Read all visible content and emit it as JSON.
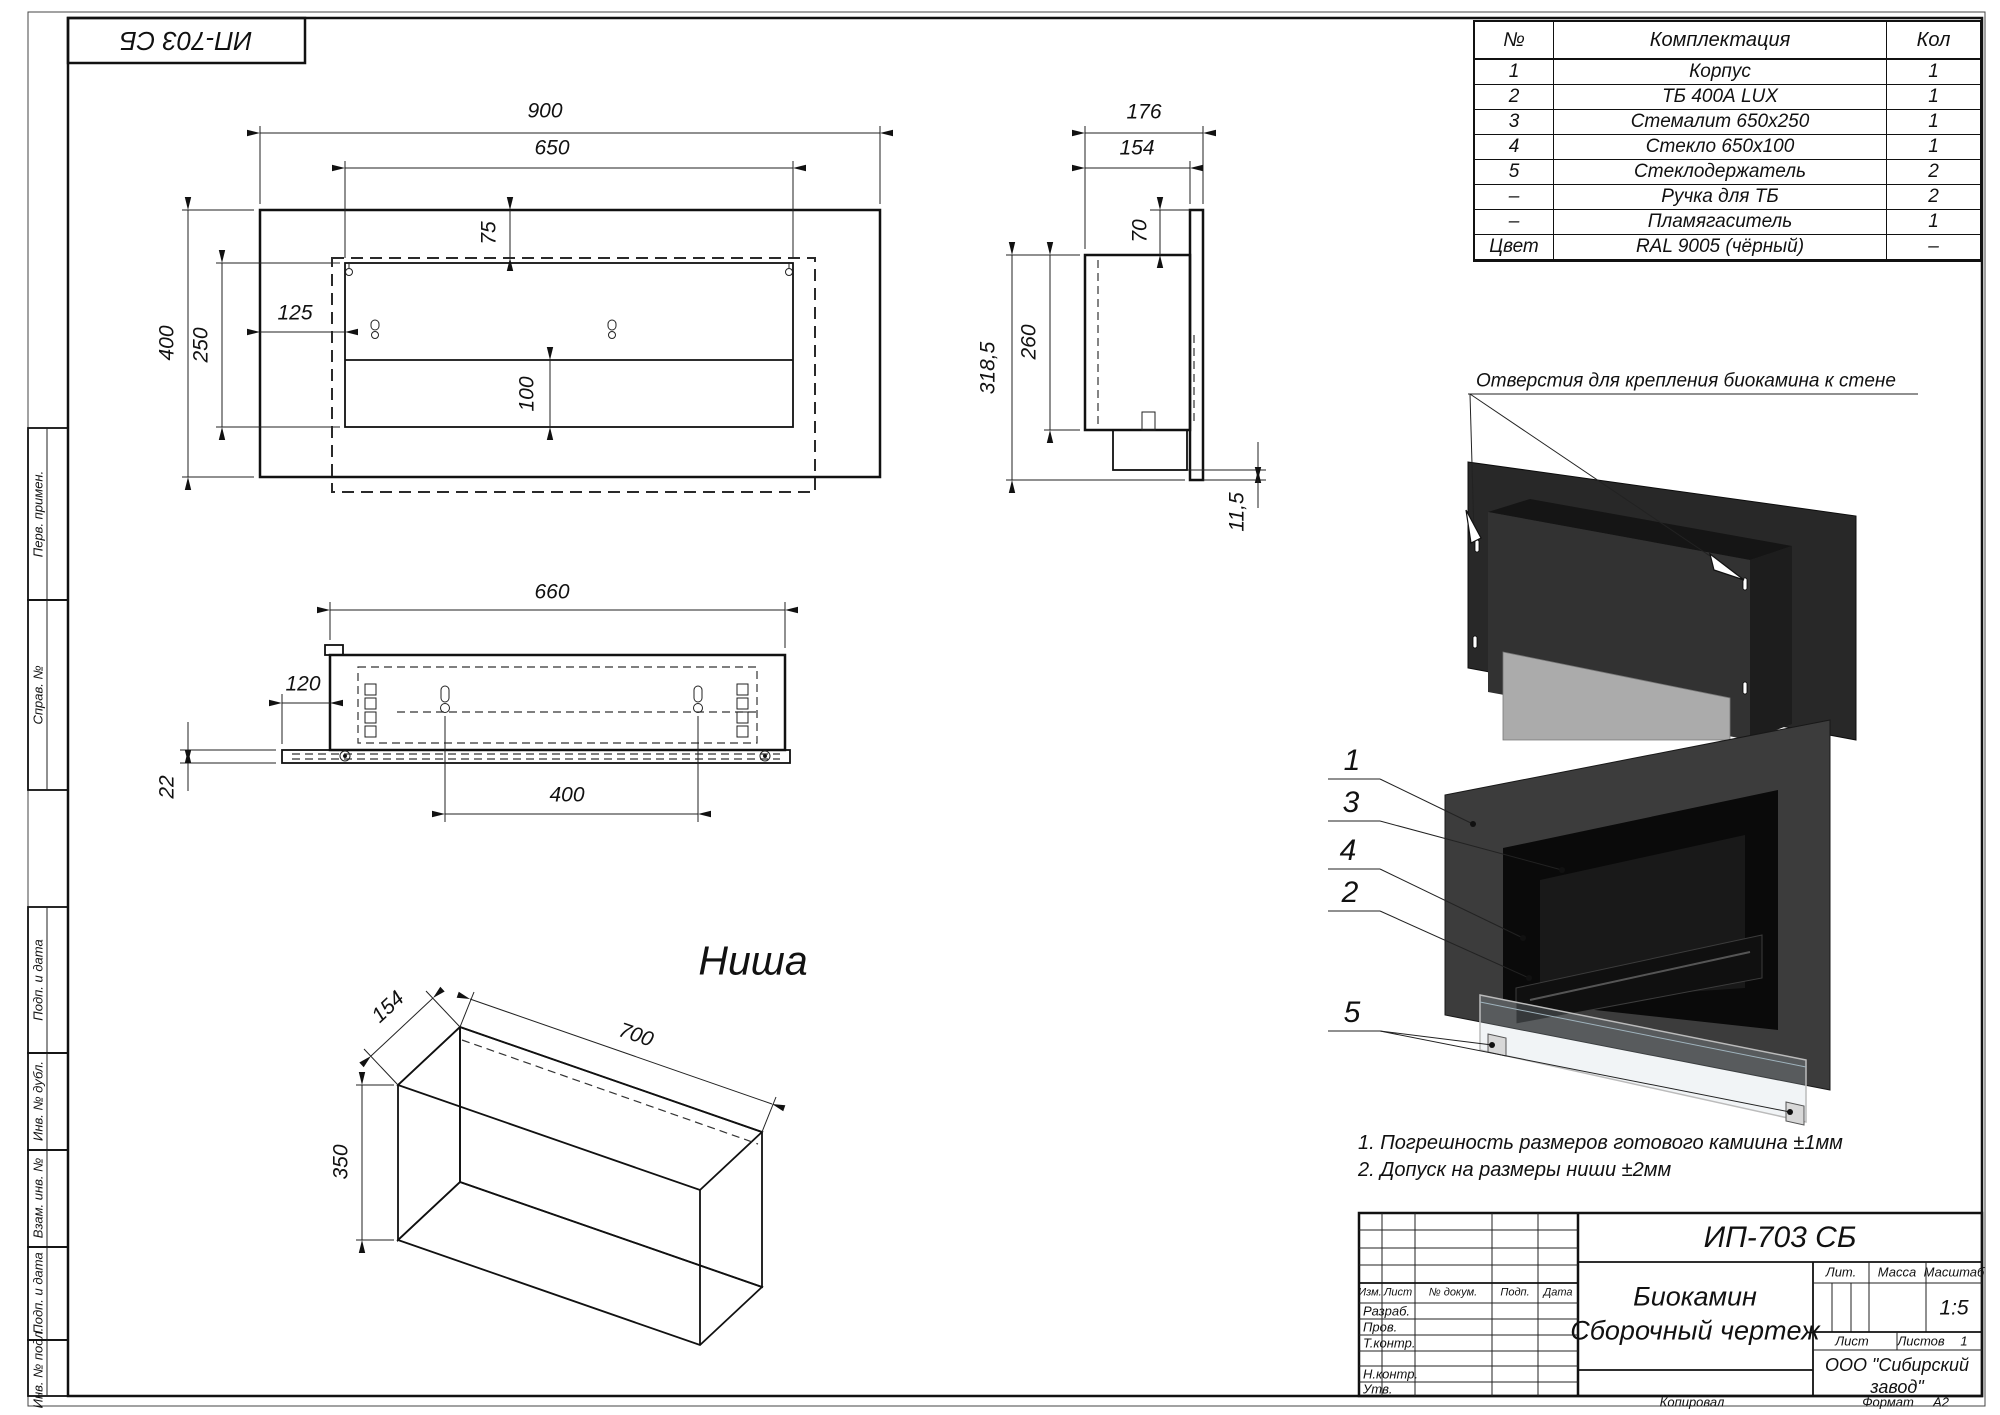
{
  "sheet": {
    "doc_number_mirrored": "ИП-703 СБ",
    "copied_label": "Копировал",
    "format_label": "Формат",
    "format_value": "А2"
  },
  "margin_labels": [
    "Перв. примен.",
    "Справ. №",
    "Подп. и дата",
    "Инв. № дубл.",
    "Взам. инв. №",
    "Подп. и дата",
    "Инв. № подл."
  ],
  "parts_table": {
    "headers": [
      "№",
      "Комплектация",
      "Кол"
    ],
    "rows": [
      [
        "1",
        "Корпус",
        "1"
      ],
      [
        "2",
        "ТБ 400А LUX",
        "1"
      ],
      [
        "3",
        "Стемалит 650х250",
        "1"
      ],
      [
        "4",
        "Стекло 650х100",
        "1"
      ],
      [
        "5",
        "Стеклодержатель",
        "2"
      ],
      [
        "–",
        "Ручка для ТБ",
        "2"
      ],
      [
        "–",
        "Пламягаситель",
        "1"
      ],
      [
        "Цвет",
        "RAL 9005 (чёрный)",
        "–"
      ]
    ]
  },
  "annotations": {
    "mount_holes_note": "Отверстия для крепления биокамина к стене",
    "niche_title": "Ниша",
    "notes": [
      "1. Погрешность размеров готового камиина ±1мм",
      "2. Допуск на размеры ниши ±2мм"
    ]
  },
  "dimensions": {
    "front": {
      "width": "900",
      "opening_width": "650",
      "top_offset": "75",
      "side_offset": "125",
      "height": "400",
      "opening_height": "250",
      "glass_height": "100"
    },
    "side": {
      "depth": "176",
      "body_depth": "154",
      "top_offset": "70",
      "body_height": "260",
      "total_height": "318,5",
      "bottom_offset": "11,5"
    },
    "bottom": {
      "body_width": "660",
      "side_offset": "120",
      "plate_thickness": "22",
      "mount_spacing": "400"
    },
    "niche": {
      "depth": "154",
      "width": "700",
      "height": "350"
    }
  },
  "callouts": [
    "1",
    "3",
    "4",
    "2",
    "5"
  ],
  "title_block": {
    "doc_number": "ИП-703 СБ",
    "product_name": "Биокамин",
    "doc_type": "Сборочный чертеж",
    "col_izm": "Изм.",
    "col_list": "Лист",
    "col_doc": "№ докум.",
    "col_podp": "Подп.",
    "col_data": "Дата",
    "row_razrab": "Разраб.",
    "row_prov": "Пров.",
    "row_tkontr": "Т.контр.",
    "row_nkontr": "Н.контр.",
    "row_utv": "Утв.",
    "lit_label": "Лит.",
    "mass_label": "Масса",
    "scale_label": "Масштаб",
    "scale_value": "1:5",
    "sheet_label": "Лист",
    "sheets_label": "Листов",
    "sheets_value": "1",
    "company_line1": "ООО \"Сибирский",
    "company_line2": "завод\""
  }
}
